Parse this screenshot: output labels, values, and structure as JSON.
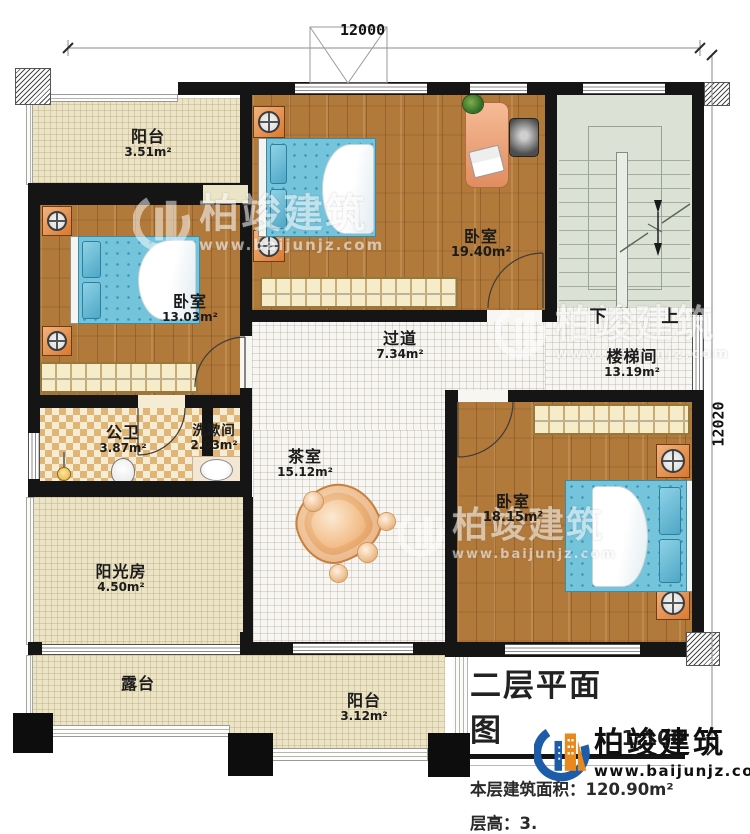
{
  "dimensions": {
    "top": "12000",
    "right": "12020"
  },
  "rooms": [
    {
      "name": "阳台",
      "area": "3.51m²"
    },
    {
      "name": "卧室",
      "area": "19.40m²"
    },
    {
      "name": "楼梯间",
      "area": "13.19m²"
    },
    {
      "name": "卧室",
      "area": "13.03m²"
    },
    {
      "name": "过道",
      "area": "7.34m²"
    },
    {
      "name": "公卫",
      "area": "3.87m²"
    },
    {
      "name": "洗漱间",
      "area": "2.03m²"
    },
    {
      "name": "茶室",
      "area": "15.12m²"
    },
    {
      "name": "卧室",
      "area": "18.15m²"
    },
    {
      "name": "阳光房",
      "area": "4.50m²"
    },
    {
      "name": "露台",
      "area": ""
    },
    {
      "name": "阳台",
      "area": "3.12m²"
    }
  ],
  "stairs": {
    "down": "下",
    "up": "上"
  },
  "title_block": {
    "title": "二层平面图",
    "scale": "1:100",
    "area_label": "本层建筑面积：",
    "area_value": "120.90m²",
    "height_label": "层高：",
    "height_value": "3."
  },
  "brand": {
    "name": "柏竣建筑",
    "website": "www.baijunjz.com"
  },
  "watermark": {
    "name": "柏竣建筑",
    "website": "www.baijunjz.com"
  },
  "colors": {
    "logo_blue": "#1d5ca8",
    "logo_orange": "#e8891d",
    "wall": "#151515"
  }
}
